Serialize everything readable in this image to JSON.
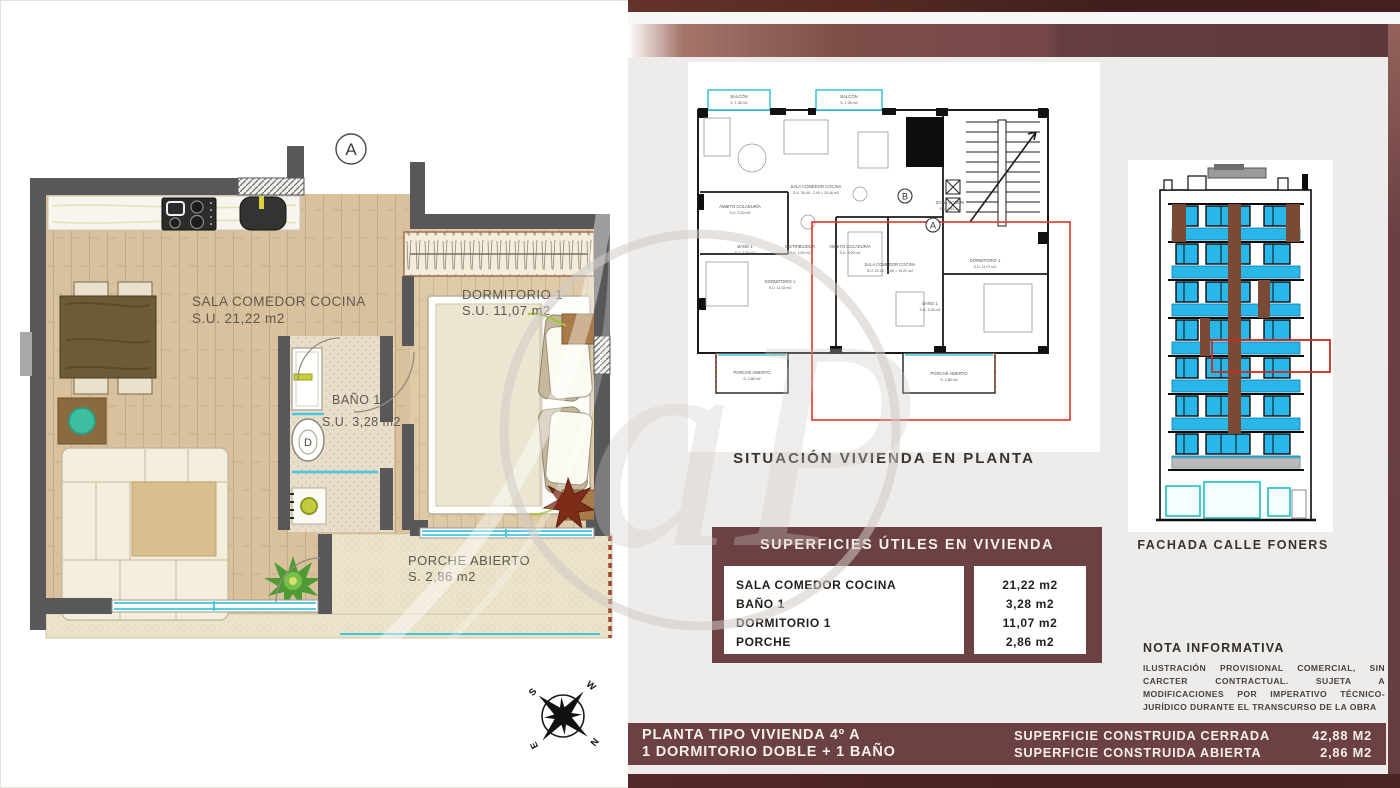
{
  "colors": {
    "maroon_panel": "#6b4144",
    "dark_maroon": "#46211f",
    "cyan": "#3fc6dc",
    "red_outline": "#e23325",
    "facade_window": "#29b6e8",
    "facade_brown": "#7b4a35",
    "wood_floor": "#d8c19c"
  },
  "main_plan": {
    "marker": "A",
    "sala": {
      "name": "SALA COMEDOR COCINA",
      "area": "S.U.  21,22 m2"
    },
    "dormitorio": {
      "name": "DORMITORIO 1",
      "area": "S.U.  11,07 m2"
    },
    "bano": {
      "name": "BAÑO 1",
      "area": "S.U.  3,28 m2"
    },
    "porche": {
      "name": "PORCHE  ABIERTO",
      "area": "S. 2,86 m2"
    },
    "toilet_label": "D",
    "compass": {
      "n": "N",
      "s": "S",
      "e": "E",
      "w": "W"
    }
  },
  "situation_plan": {
    "caption": "SITUACIÓN VIVIENDA EN PLANTA",
    "marker_a": "A",
    "marker_b": "B",
    "labels": [
      {
        "l1": "BALCÓN",
        "l2": "S. 1,36 m2"
      },
      {
        "l1": "BALCÓN",
        "l2": "S. 1,28 m2"
      },
      {
        "l1": "SALA COMEDOR COCINA",
        "l2": "S.U.  26,40 - 2,00 = 24,40 m2"
      },
      {
        "l1": "ZONA COMÚN",
        "l2": "S.U.  4,61 m2"
      },
      {
        "l1": "DORMITORIO 1",
        "l2": "S.U.  11,02 m2"
      },
      {
        "l1": "BAÑO 1",
        "l2": "S.U.  3,76 m2"
      },
      {
        "l1": "DISTRIBUIDOR",
        "l2": "S.U.  1,52 m2"
      },
      {
        "l1": "ÁMBITO COLADURÍA",
        "l2": "S.U.  2,00 m2"
      },
      {
        "l1": "ÁMBITO COLADURÍA",
        "l2": "S.U.  2,00 m2"
      },
      {
        "l1": "SALA COMEDOR COCINA",
        "l2": "S.U.  21,22 - 2,00 = 19,22 m2"
      },
      {
        "l1": "DORMITORIO 1",
        "l2": "S.U.  11,07 m2"
      },
      {
        "l1": "BAÑO 1",
        "l2": "S.U.  3,28 m2"
      },
      {
        "l1": "PORCHE ABIERTO",
        "l2": "S. 2,88 m2"
      },
      {
        "l1": "PORCHE ABIERTO",
        "l2": "S. 2,86 m2"
      }
    ]
  },
  "facade": {
    "caption": "FACHADA CALLE FONERS"
  },
  "surface_table": {
    "title": "SUPERFICIES ÚTILES EN VIVIENDA",
    "rows": [
      {
        "name": "SALA COMEDOR COCINA",
        "value": "21,22 m2"
      },
      {
        "name": "BAÑO 1",
        "value": "3,28 m2"
      },
      {
        "name": "DORMITORIO 1",
        "value": "11,07 m2"
      },
      {
        "name": "PORCHE",
        "value": "2,86 m2"
      }
    ]
  },
  "nota": {
    "title": "NOTA INFORMATIVA",
    "body": "ILUSTRACIÓN PROVISIONAL COMERCIAL, SIN CARCTER CONTRACTUAL. SUJETA A MODIFICACIONES POR IMPERATIVO TÉCNICO-JURÍDICO DURANTE EL TRANSCURSO DE LA OBRA"
  },
  "footer": {
    "line1": "PLANTA TIPO VIVIENDA 4º A",
    "line2": "1 DORMITORIO DOBLE + 1 BAÑO",
    "right": [
      {
        "label": "SUPERFICIE CONSTRUIDA CERRADA",
        "value": "42,88 M2"
      },
      {
        "label": "SUPERFICIE CONSTRUIDA ABIERTA",
        "value": "2,86 M2"
      }
    ]
  }
}
